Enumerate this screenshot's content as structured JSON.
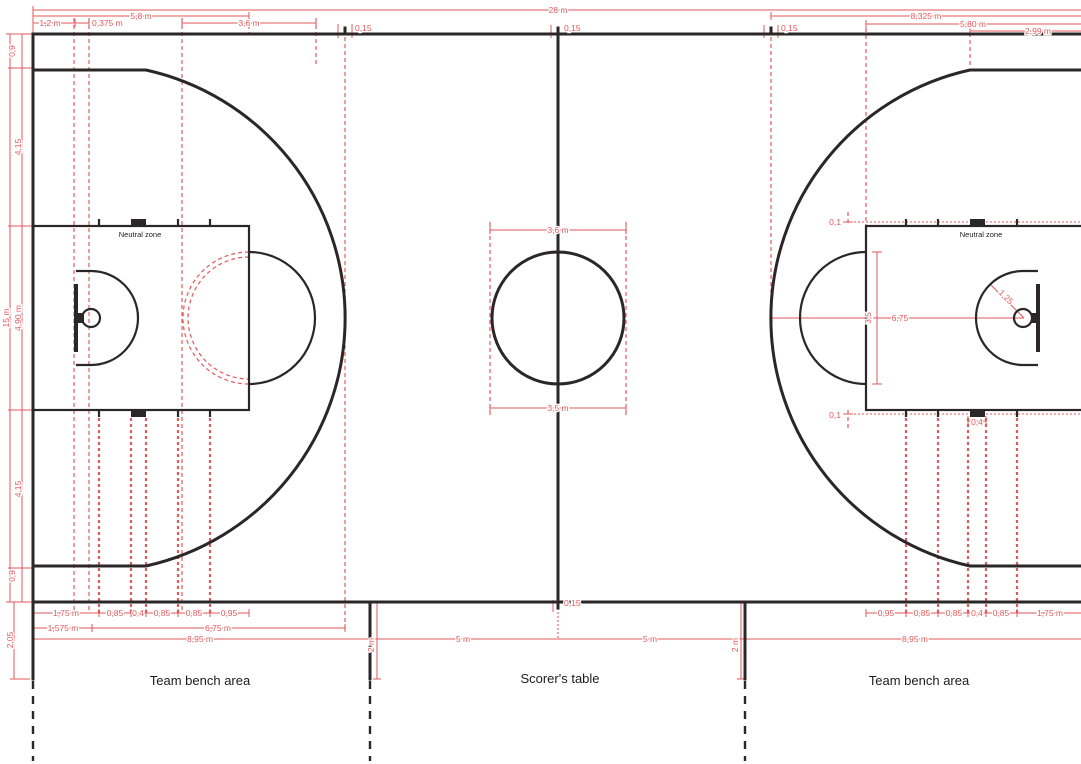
{
  "labels": {
    "neutral_zone_left": "Neutral zone",
    "neutral_zone_right": "Neutral zone",
    "team_bench_left": "Team bench area",
    "scorers_table": "Scorer's table",
    "team_bench_right": "Team bench area"
  },
  "dims": {
    "top": {
      "overall": "28 m",
      "ft_line": "5,8 m",
      "backboard": "1,2 m",
      "ring": "0,375 m",
      "ft_circle": "3,6 m",
      "throwin_left": "0,15",
      "center": "0,15",
      "throwin_right": "0,15",
      "throwin_dist": "8,325 m",
      "ft_line_right": "5,80 m",
      "three_straight": "2,99 m"
    },
    "left": {
      "margin_top": "0,9",
      "upper": "4,15",
      "width": "15 m",
      "key_width": "4,90 m",
      "lower": "4,15",
      "margin_bottom": "0,9"
    },
    "center_circle": {
      "outer": "3,6 m",
      "inner": "3,5 m"
    },
    "right_court": {
      "hash_top": "0,1",
      "hash_bottom": "0,1",
      "block": "0,4",
      "ft_circle": "3,5",
      "three_radius": "6,75",
      "no_charge": "1,25"
    },
    "bottom_left": {
      "row1": [
        "1,75 m",
        "0,85",
        "0,4",
        "0,85",
        "0,85",
        "0,95"
      ],
      "basket": "1,575 m",
      "three_radius": "6,75 m",
      "total": "8,95 m",
      "bench_depth": "2,05"
    },
    "bottom_center": {
      "center_ext": "0,15",
      "left_dist": "5 m",
      "right_dist": "5 m",
      "bench_left": "2 m",
      "bench_right": "2 m"
    },
    "bottom_right": {
      "row1": [
        "0,95",
        "0,85",
        "0,85",
        "0,4",
        "0,85",
        "1,75 m"
      ],
      "total": "8,95 m"
    }
  },
  "colors": {
    "court_line": "#2b2627",
    "dimension": "#e2595b",
    "background": "#ffffff"
  }
}
